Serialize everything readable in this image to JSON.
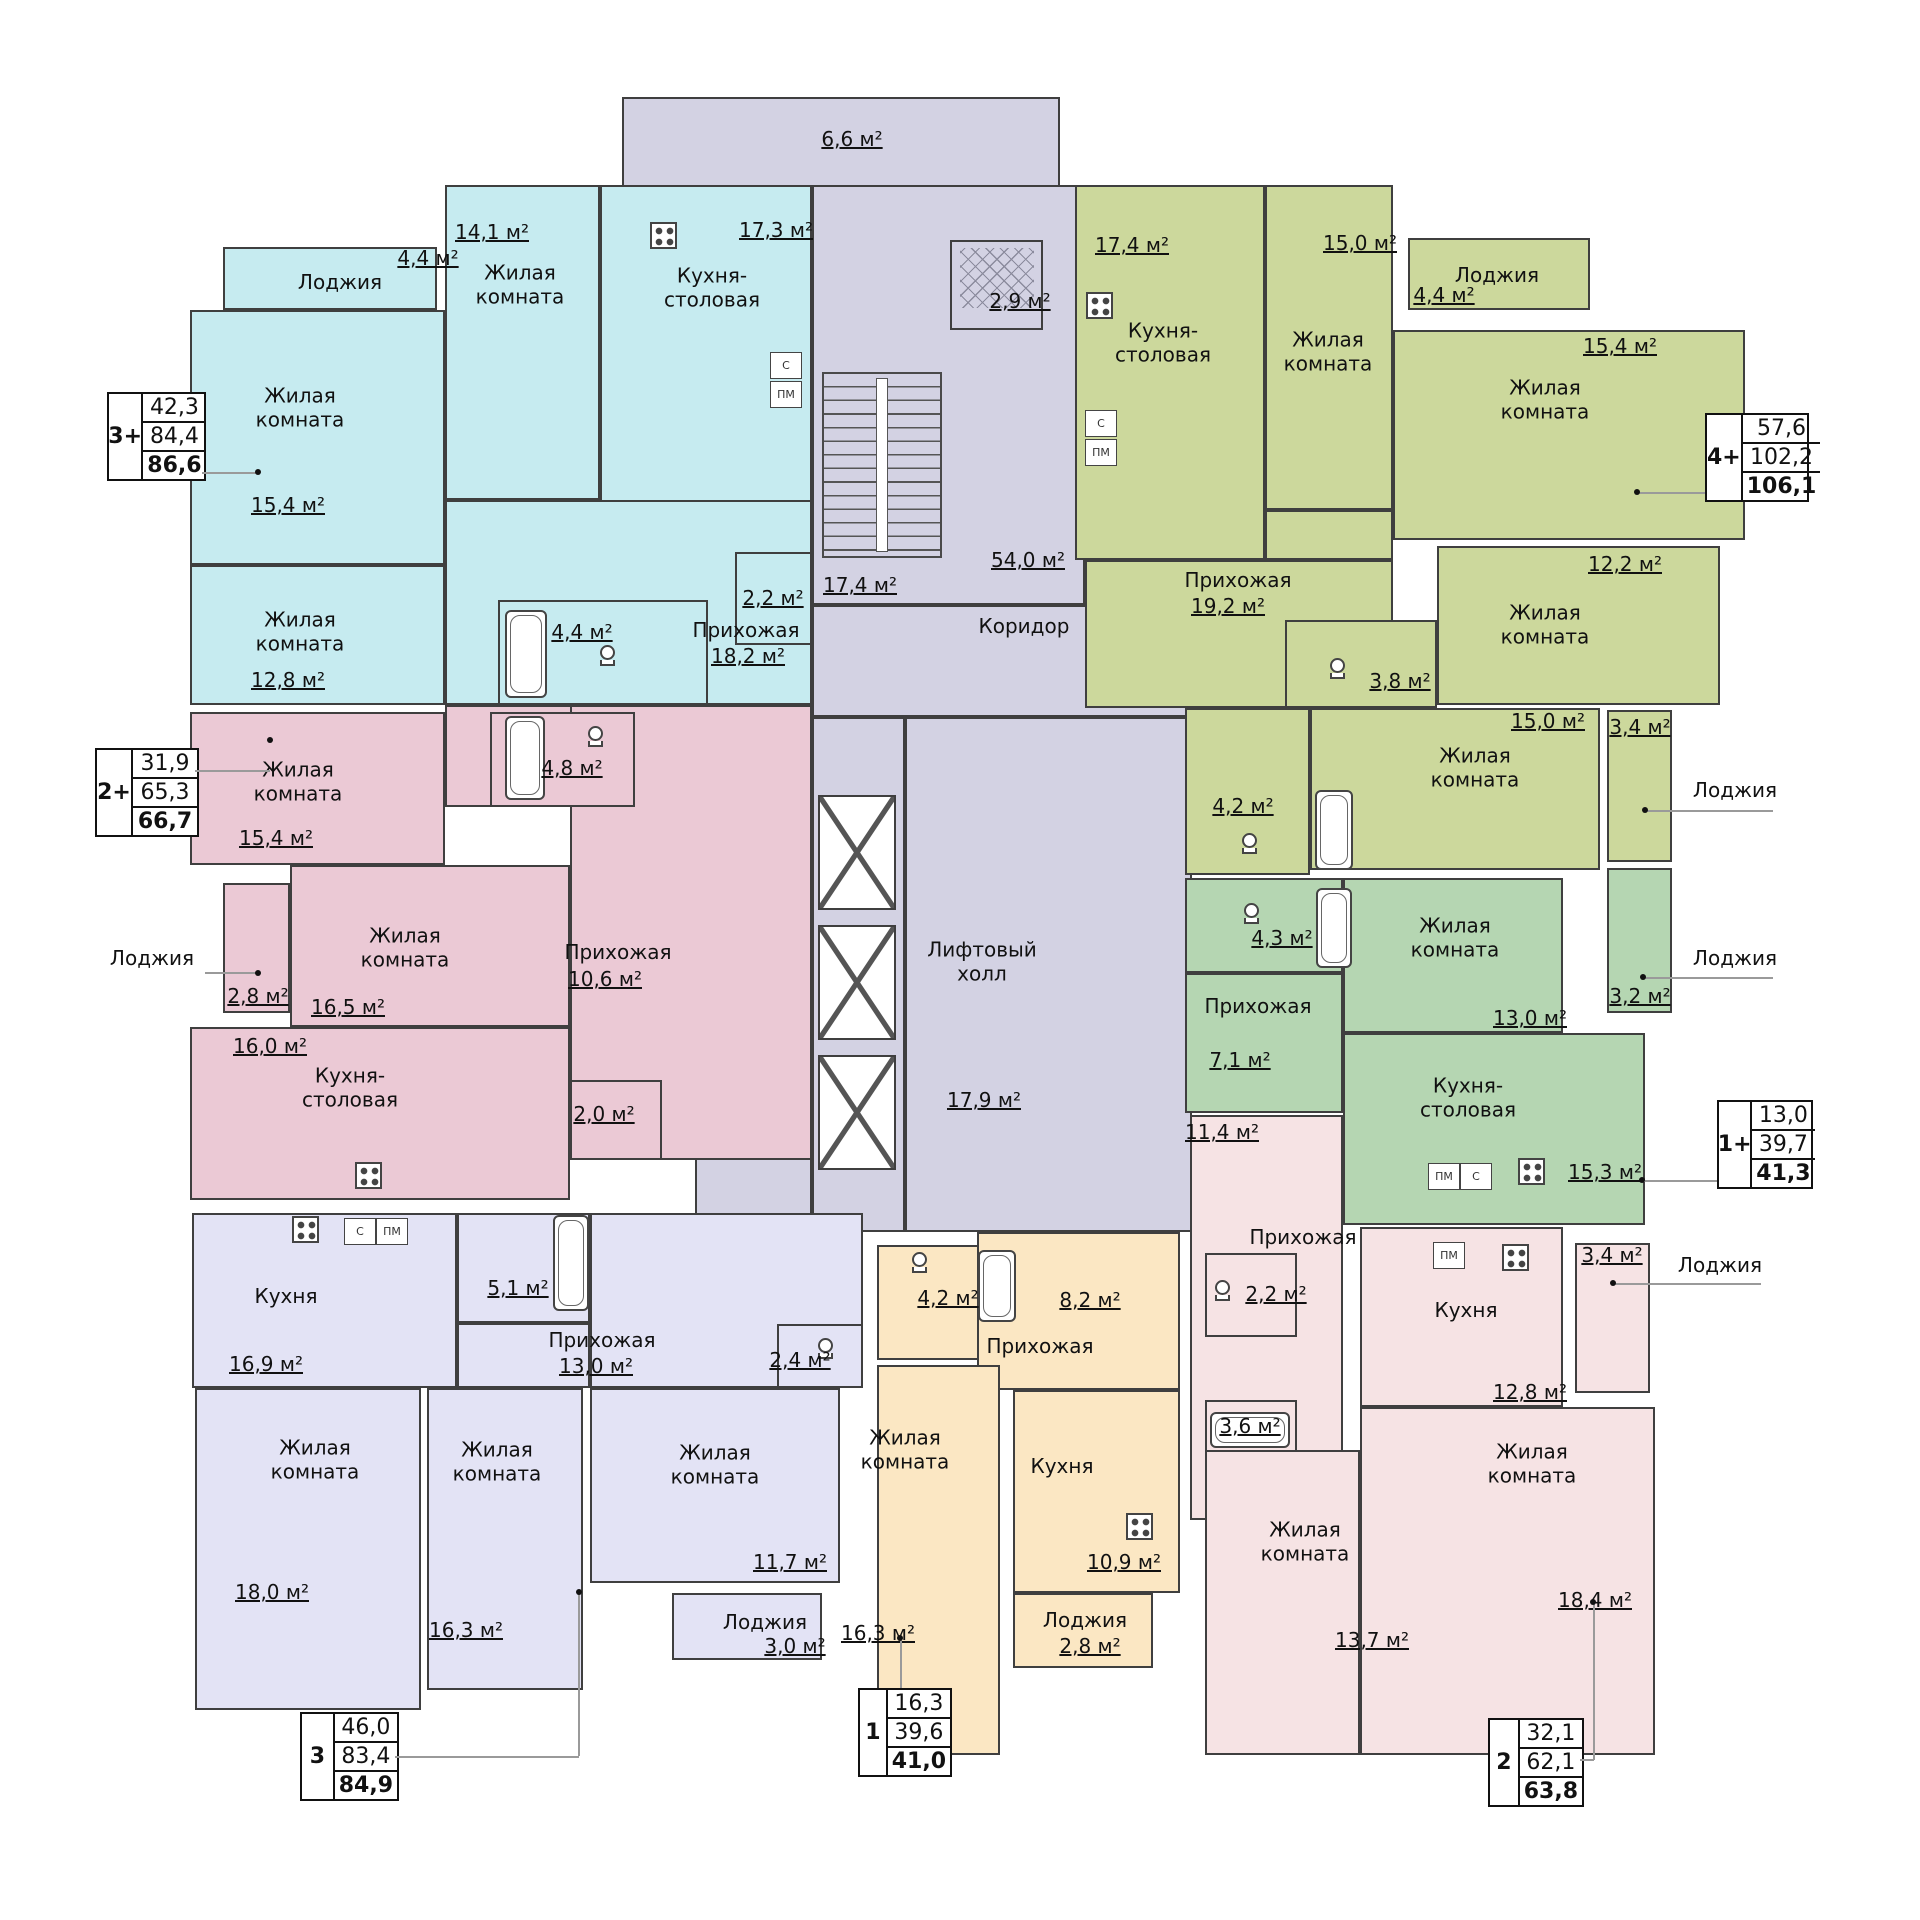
{
  "colors": {
    "cyan": "#c6ebf0",
    "green": "#ccd89c",
    "rose": "#ebc9d5",
    "teal": "#b5d6b2",
    "lavender": "#e3e3f5",
    "cream": "#fbe7c3",
    "pink": "#f6e3e4",
    "core": "#d3d2e3",
    "wall": "#3f3f3f"
  },
  "strings": {
    "living_room": "Жилая комната",
    "loggia": "Лоджия",
    "kitchen": "Кухня",
    "kitchen_dining": "Кухня-столовая",
    "hallway": "Прихожая",
    "corridor": "Коридор",
    "elevator_hall": "Лифтовый холл",
    "s": "С",
    "pm": "ПМ"
  },
  "areas": {
    "c_loggia": "4,4 м²",
    "c_r1": "15,4 м²",
    "c_r2": "12,8 м²",
    "c_r3": "14,1 м²",
    "c_kit": "17,3 м²",
    "c_bath": "4,4 м²",
    "c_wc": "2,2 м²",
    "c_hall": "18,2 м²",
    "g_kit": "17,4 м²",
    "g_r1": "15,0 м²",
    "g_log1": "4,4 м²",
    "g_r2": "15,4 м²",
    "g_r3": "12,2 м²",
    "g_hall": "19,2 м²",
    "g_bath": "3,8 м²",
    "g_wc": "4,2 м²",
    "g_r4": "15,0 м²",
    "g_log2": "3,4 м²",
    "p_r1": "15,4 м²",
    "p_log": "2,8 м²",
    "p_r2": "16,5 м²",
    "p_kit": "16,0 м²",
    "p_bath": "4,8 м²",
    "p_wc": "2,0 м²",
    "p_hall": "10,6 м²",
    "t_bath": "4,3 м²",
    "t_hall": "7,1 м²",
    "t_r1": "13,0 м²",
    "t_kit": "15,3 м²",
    "t_log": "3,2 м²",
    "l_kit": "16,9 м²",
    "l_bath": "5,1 м²",
    "l_hall": "13,0 м²",
    "l_wc": "2,4 м²",
    "l_r1": "18,0 м²",
    "l_r2": "16,3 м²",
    "l_r3": "11,7 м²",
    "l_log": "3,0 м²",
    "y_bath": "4,2 м²",
    "y_hall": "8,2 м²",
    "y_r1": "16,3 м²",
    "y_kit": "10,9 м²",
    "y_log": "2,8 м²",
    "b_hall": "11,4 м²",
    "b_wc": "2,2 м²",
    "b_bath": "3,6 м²",
    "b_kit": "12,8 м²",
    "b_log": "3,4 м²",
    "b_r1": "18,4 м²",
    "b_r2": "13,7 м²",
    "core_balcony": "6,6 м²",
    "core_stairs": "17,4 м²",
    "core_vest": "2,9 м²",
    "core_corr": "54,0 м²",
    "core_lift": "17,9 м²"
  },
  "stats": {
    "a3p": {
      "label": "3+",
      "values": [
        "42,3",
        "84,4",
        "86,6"
      ]
    },
    "a4p": {
      "label": "4+",
      "values": [
        "57,6",
        "102,2",
        "106,1"
      ]
    },
    "a2p": {
      "label": "2+",
      "values": [
        "31,9",
        "65,3",
        "66,7"
      ]
    },
    "a1p": {
      "label": "1+",
      "values": [
        "13,0",
        "39,7",
        "41,3"
      ]
    },
    "a3": {
      "label": "3",
      "values": [
        "46,0",
        "83,4",
        "84,9"
      ]
    },
    "a1": {
      "label": "1",
      "values": [
        "16,3",
        "39,6",
        "41,0"
      ]
    },
    "a2": {
      "label": "2",
      "values": [
        "32,1",
        "62,1",
        "63,8"
      ]
    }
  }
}
